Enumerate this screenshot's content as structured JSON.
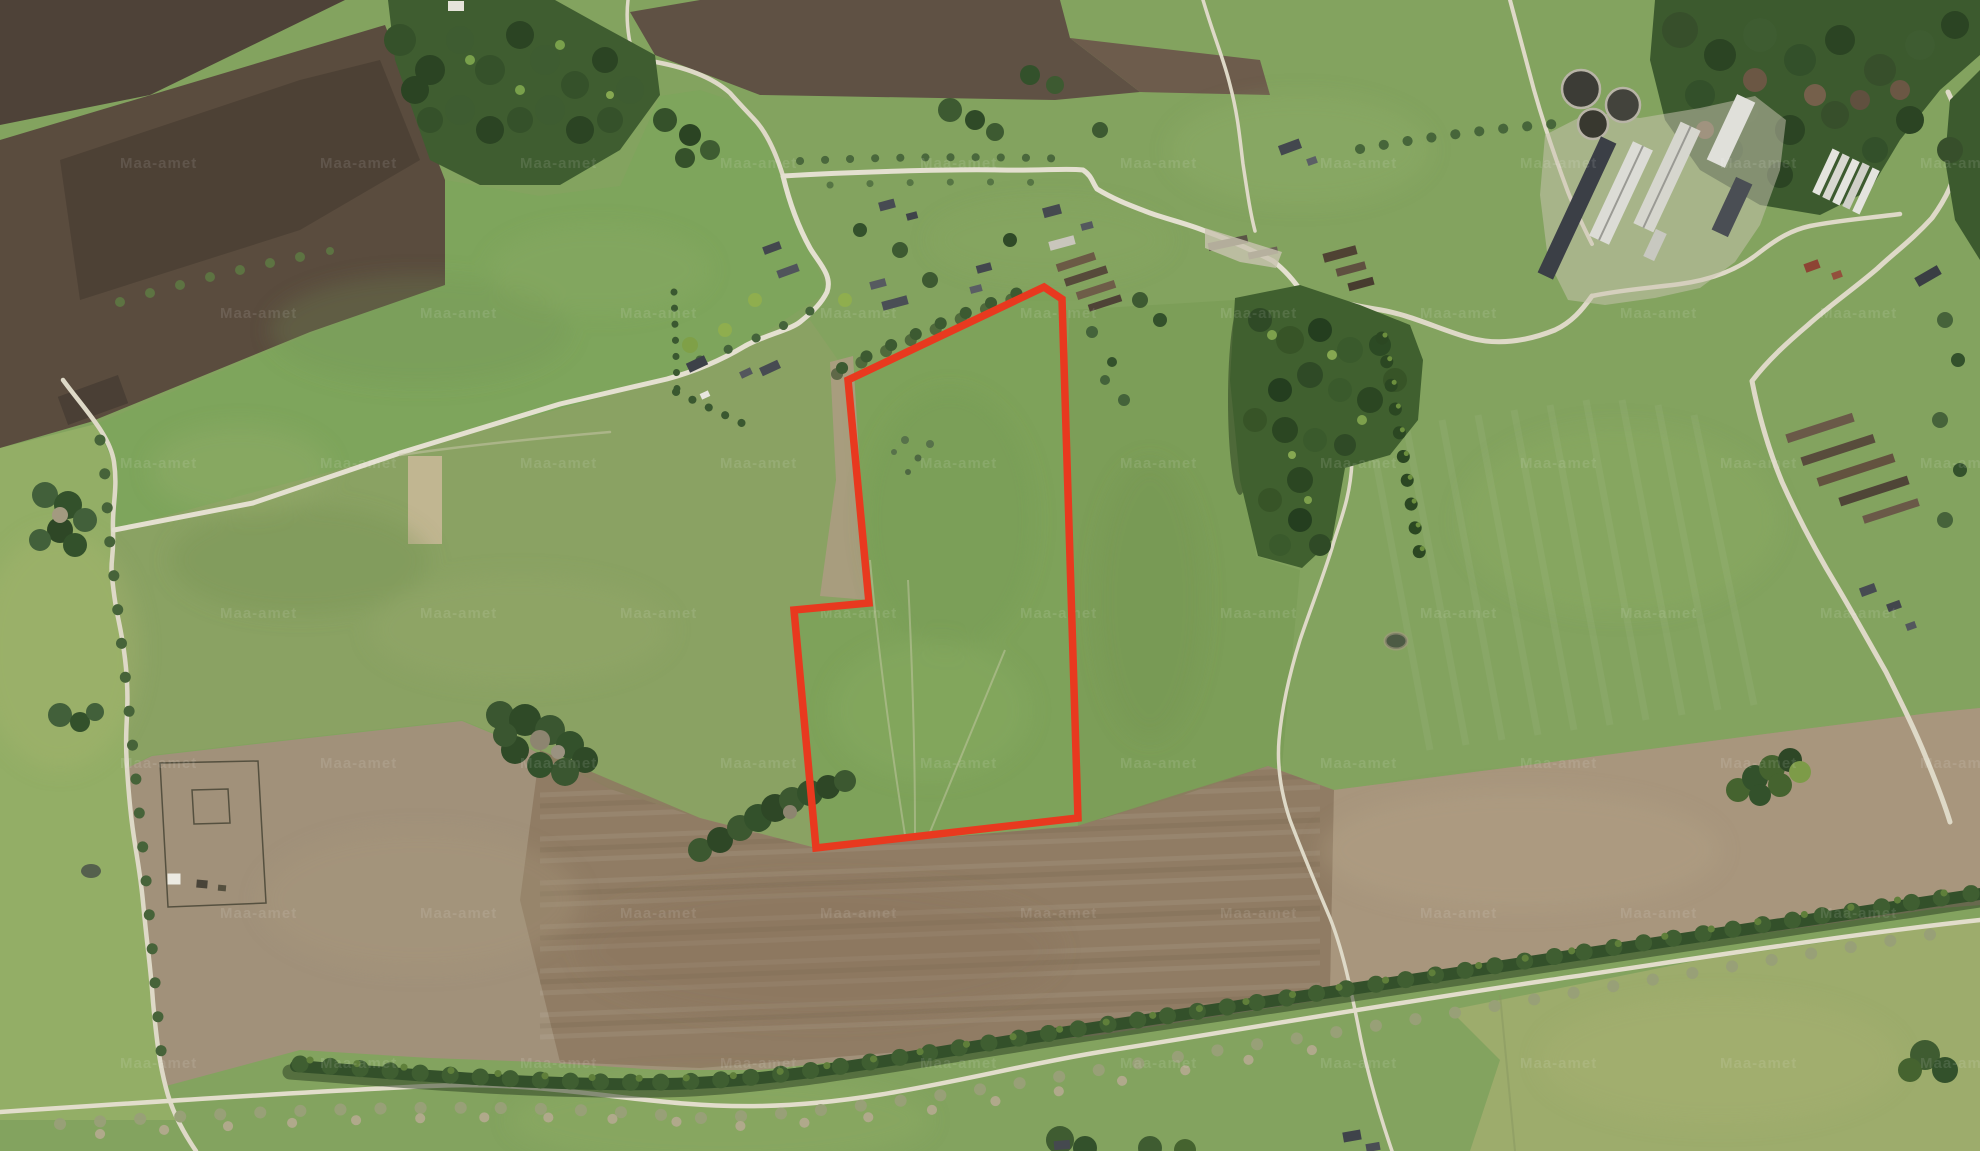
{
  "map": {
    "kind": "aerial-orthophoto-with-parcel-overlay",
    "watermark": {
      "text": "Maa-amet",
      "color": "#ffffff",
      "opacity": 0.11,
      "font_size": 15,
      "grid": {
        "x_start": 120,
        "x_step": 200,
        "x_count": 10,
        "y_start": 168,
        "y_step": 150,
        "y_count": 7
      }
    },
    "parcel": {
      "outline_color": "#e8391f",
      "stroke_width": 7.5,
      "interior_tint": "#7ea25a",
      "vertices": [
        [
          1044,
          287
        ],
        [
          1062,
          299
        ],
        [
          1078,
          818
        ],
        [
          816,
          848
        ],
        [
          794,
          610
        ],
        [
          869,
          603
        ],
        [
          848,
          380
        ]
      ]
    },
    "palette": {
      "field_green": "#83a35f",
      "field_bright": "#93ae66",
      "field_pale": "#9dac6c",
      "soil_dark": "#4e4238",
      "soil_brown": "#5f5144",
      "soil_tan": "#a1917a",
      "soil_plow": "#8d7860",
      "forest": "#3f5d30",
      "forest_dark": "#2c4723",
      "road": "#ded9c7",
      "roof_dark": "#43474e",
      "roof_light": "#dcdcd6",
      "roof_red": "#8d4434"
    }
  }
}
